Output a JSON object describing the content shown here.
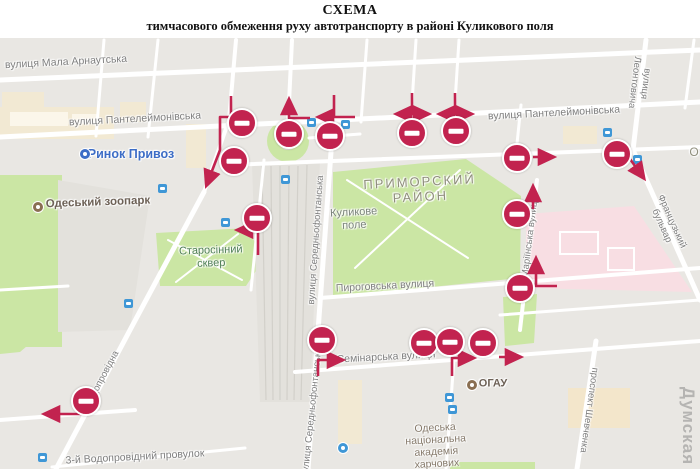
{
  "title": {
    "line1": "СХЕМА",
    "line2": "тимчасового обмеження руху автотранспорту в районі Куликового поля"
  },
  "map": {
    "watermark": "Думская",
    "colors": {
      "background": "#e9e7e3",
      "road": "#ffffff",
      "park": "#cbe6a4",
      "pink_zone": "#f8dee3",
      "building": "#f2e9d3",
      "sign_red": "#c2234f",
      "transit_blue": "#3f97d6",
      "poi_brown": "#8a6f52",
      "street_label": "#7e7e7e",
      "district_label": "#8f8e7c"
    },
    "labels": [
      {
        "name": "street-label-mala-arnautska",
        "text": "вулиця Мала Арнаутська",
        "x": 66,
        "y": 62,
        "rot": -3,
        "size": 10.5
      },
      {
        "name": "street-label-panteleimonivska-left",
        "text": "вулиця Пантелеймонівська",
        "x": 135,
        "y": 119,
        "rot": -3,
        "size": 10.5
      },
      {
        "name": "street-label-panteleimonivska-right",
        "text": "вулиця Пантелеймонівська",
        "x": 554,
        "y": 113,
        "rot": -3,
        "size": 10.5
      },
      {
        "name": "street-label-pyrohovska",
        "text": "Пироговська вулиця",
        "x": 385,
        "y": 286,
        "rot": -3,
        "size": 10.5
      },
      {
        "name": "street-label-seminarska",
        "text": "Семінарська вулиця",
        "x": 386,
        "y": 357,
        "rot": -3,
        "size": 10.5
      },
      {
        "name": "street-label-vodoprovidnyi-prov",
        "text": "3-й Водопровідний провулок",
        "x": 135,
        "y": 457,
        "rot": -3,
        "size": 10.5
      },
      {
        "name": "street-label-serednofontanska-1",
        "text": "вулиця Середньофонтанська",
        "x": 317,
        "y": 240,
        "rot": -86,
        "size": 9.5
      },
      {
        "name": "street-label-serednofontanska-2",
        "text": "вулиця Середньофонтанська",
        "x": 313,
        "y": 412,
        "rot": -84,
        "size": 9.5
      },
      {
        "name": "street-label-mariinska",
        "text": "Маріїнська вулиця",
        "x": 531,
        "y": 237,
        "rot": -83,
        "size": 9.5
      },
      {
        "name": "street-label-leontovycha",
        "text": "вулиця Леонтовича",
        "x": 639,
        "y": 83,
        "rot": 97,
        "size": 9.5
      },
      {
        "name": "street-label-shevchenka",
        "text": "проспект Шевченка",
        "x": 588,
        "y": 410,
        "rot": 98,
        "size": 9.5
      },
      {
        "name": "street-label-vodoprovidna",
        "text": "Водопровідна",
        "x": 103,
        "y": 379,
        "rot": -62,
        "size": 9.5
      },
      {
        "name": "street-label-frantsuzkyi-bulvar",
        "text": "Французький бульвар",
        "x": 666,
        "y": 224,
        "rot": 66,
        "size": 9.5
      },
      {
        "name": "district-label-prymorskyi",
        "text": "ПРИМОРСКИЙ\nРАЙОН",
        "x": 420,
        "y": 190,
        "rot": -3,
        "size": 13,
        "ls": 2,
        "color": "#8f8e7c"
      },
      {
        "name": "area-label-kulykove-pole",
        "text": "Куликове\nполе",
        "x": 354,
        "y": 219,
        "rot": -3,
        "size": 11,
        "color": "#7b847b"
      },
      {
        "name": "park-label-starosinnyi-skver",
        "text": "Старосінний\nсквер",
        "x": 211,
        "y": 257,
        "rot": -2,
        "size": 11,
        "color": "#4f7f55"
      },
      {
        "name": "poi-label-academy",
        "text": "Одеська\nнаціональна\nакадемія\nхарчових",
        "x": 436,
        "y": 446,
        "rot": -3,
        "size": 10.5,
        "color": "#85796a"
      },
      {
        "name": "poi-label-rynok-pryvoz",
        "text": "Ринок Привоз",
        "x": 131,
        "y": 154,
        "rot": 0,
        "size": 12.5,
        "bold": true,
        "color": "#3d6dc6"
      },
      {
        "name": "poi-label-zoo",
        "text": "Одеський зоопарк",
        "x": 98,
        "y": 203,
        "rot": -2,
        "size": 11.5,
        "bold": true,
        "color": "#6d6156"
      },
      {
        "name": "poi-label-ogau",
        "text": "ОГАУ",
        "x": 493,
        "y": 384,
        "rot": 0,
        "size": 11,
        "bold": true,
        "color": "#6d6156"
      },
      {
        "name": "poi-label-cutoff",
        "text": "О",
        "x": 694,
        "y": 153,
        "rot": 0,
        "size": 12,
        "color": "#8f8e7c"
      }
    ],
    "signs": [
      {
        "x": 242,
        "y": 123
      },
      {
        "x": 289,
        "y": 134
      },
      {
        "x": 330,
        "y": 136
      },
      {
        "x": 412,
        "y": 133
      },
      {
        "x": 456,
        "y": 131
      },
      {
        "x": 234,
        "y": 161
      },
      {
        "x": 257,
        "y": 218
      },
      {
        "x": 517,
        "y": 158
      },
      {
        "x": 617,
        "y": 154
      },
      {
        "x": 517,
        "y": 214
      },
      {
        "x": 520,
        "y": 288
      },
      {
        "x": 86,
        "y": 401
      },
      {
        "x": 322,
        "y": 340
      },
      {
        "x": 424,
        "y": 343
      },
      {
        "x": 450,
        "y": 342
      },
      {
        "x": 483,
        "y": 343
      }
    ],
    "arrows": [
      {
        "pts": [
          [
            231,
            96
          ],
          [
            231,
            117
          ],
          [
            220,
            117
          ],
          [
            220,
            150
          ],
          [
            207,
            184
          ]
        ]
      },
      {
        "pts": [
          [
            310,
            118
          ],
          [
            289,
            118
          ],
          [
            289,
            101
          ]
        ]
      },
      {
        "pts": [
          [
            334,
            95
          ],
          [
            334,
            116
          ]
        ],
        "head": false
      },
      {
        "pts": [
          [
            355,
            117
          ],
          [
            320,
            117
          ]
        ]
      },
      {
        "pts": [
          [
            412,
            93
          ],
          [
            412,
            113
          ]
        ],
        "head": false
      },
      {
        "pts": [
          [
            412,
            114
          ],
          [
            398,
            114
          ]
        ]
      },
      {
        "pts": [
          [
            412,
            114
          ],
          [
            427,
            114
          ]
        ]
      },
      {
        "pts": [
          [
            455,
            93
          ],
          [
            455,
            113
          ]
        ],
        "head": false
      },
      {
        "pts": [
          [
            455,
            114
          ],
          [
            441,
            114
          ]
        ]
      },
      {
        "pts": [
          [
            455,
            114
          ],
          [
            470,
            114
          ]
        ]
      },
      {
        "pts": [
          [
            533,
            157
          ],
          [
            552,
            157
          ]
        ]
      },
      {
        "pts": [
          [
            630,
            159
          ],
          [
            643,
            177
          ]
        ]
      },
      {
        "pts": [
          [
            533,
            209
          ],
          [
            533,
            188
          ]
        ]
      },
      {
        "pts": [
          [
            557,
            286
          ],
          [
            536,
            286
          ],
          [
            536,
            260
          ]
        ]
      },
      {
        "pts": [
          [
            258,
            255
          ],
          [
            258,
            230
          ],
          [
            239,
            230
          ]
        ]
      },
      {
        "pts": [
          [
            318,
            376
          ],
          [
            318,
            360
          ],
          [
            341,
            360
          ]
        ]
      },
      {
        "pts": [
          [
            452,
            376
          ],
          [
            452,
            358
          ],
          [
            472,
            358
          ]
        ]
      },
      {
        "pts": [
          [
            499,
            357
          ],
          [
            519,
            357
          ]
        ]
      },
      {
        "pts": [
          [
            84,
            414
          ],
          [
            46,
            414
          ]
        ]
      }
    ],
    "transit_icons": [
      {
        "x": 162,
        "y": 188
      },
      {
        "x": 225,
        "y": 222
      },
      {
        "x": 128,
        "y": 303
      },
      {
        "x": 285,
        "y": 179
      },
      {
        "x": 311,
        "y": 122
      },
      {
        "x": 345,
        "y": 124
      },
      {
        "x": 607,
        "y": 132
      },
      {
        "x": 637,
        "y": 159
      },
      {
        "x": 449,
        "y": 397
      },
      {
        "x": 452,
        "y": 409
      },
      {
        "x": 42,
        "y": 457
      }
    ],
    "poi_icons": [
      {
        "x": 85,
        "y": 154,
        "color": "#3d6dc6",
        "name": "market-icon"
      },
      {
        "x": 343,
        "y": 448,
        "color": "#3f97d6",
        "name": "transit-stop-icon"
      },
      {
        "x": 38,
        "y": 207,
        "color": "#8a6f52",
        "name": "zoo-icon"
      },
      {
        "x": 472,
        "y": 385,
        "color": "#8a6f52",
        "name": "university-icon"
      }
    ]
  }
}
